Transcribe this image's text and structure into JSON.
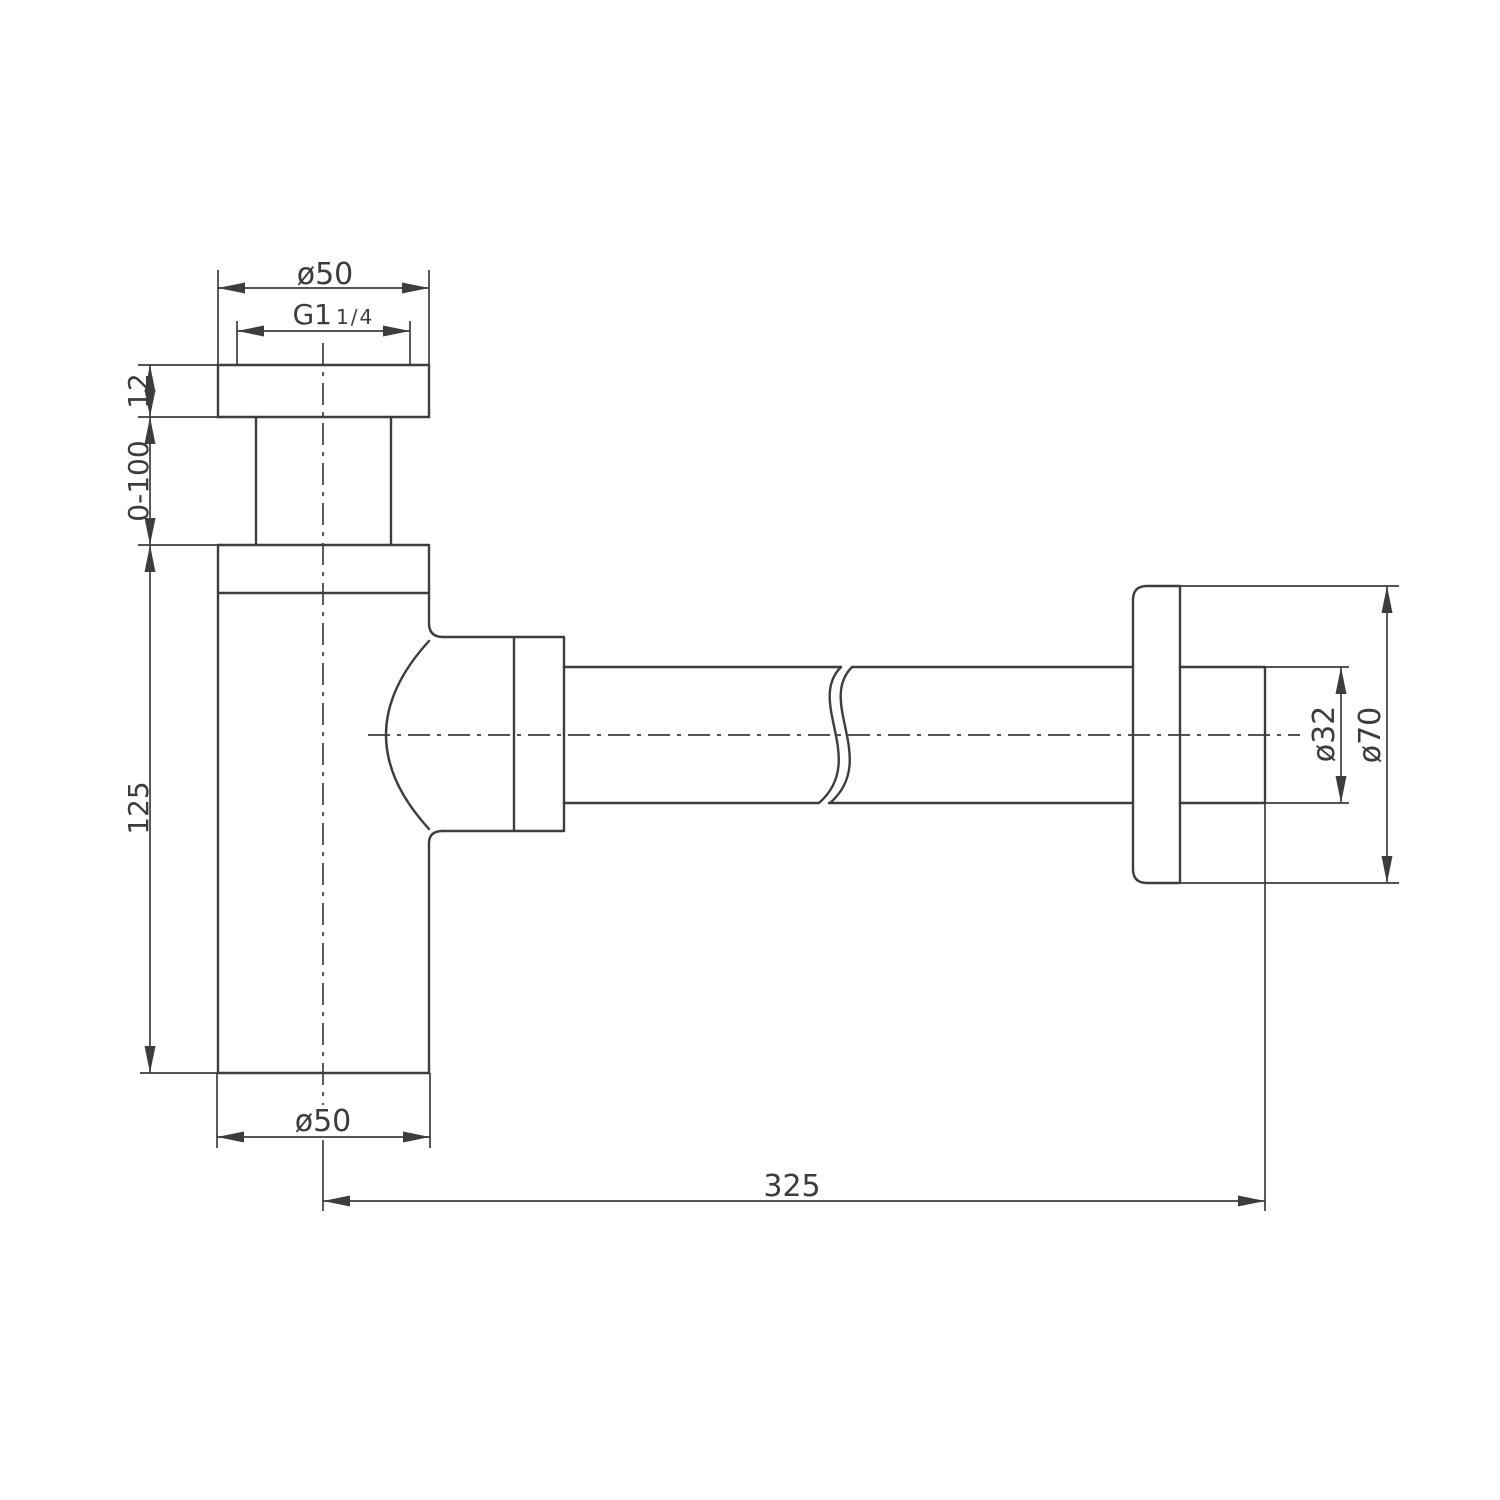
{
  "drawing": {
    "labels": {
      "top_diameter": "ø50",
      "thread_size": "G1",
      "thread_fraction": "1/4",
      "flange_thickness": "12",
      "height_adjust_range": "0-100",
      "body_height": "125",
      "body_diameter": "ø50",
      "wall_offset": "325",
      "pipe_diameter": "ø32",
      "rosette_diameter": "ø70"
    },
    "colors": {
      "line": "#3d3d3d",
      "background": "#ffffff"
    }
  }
}
